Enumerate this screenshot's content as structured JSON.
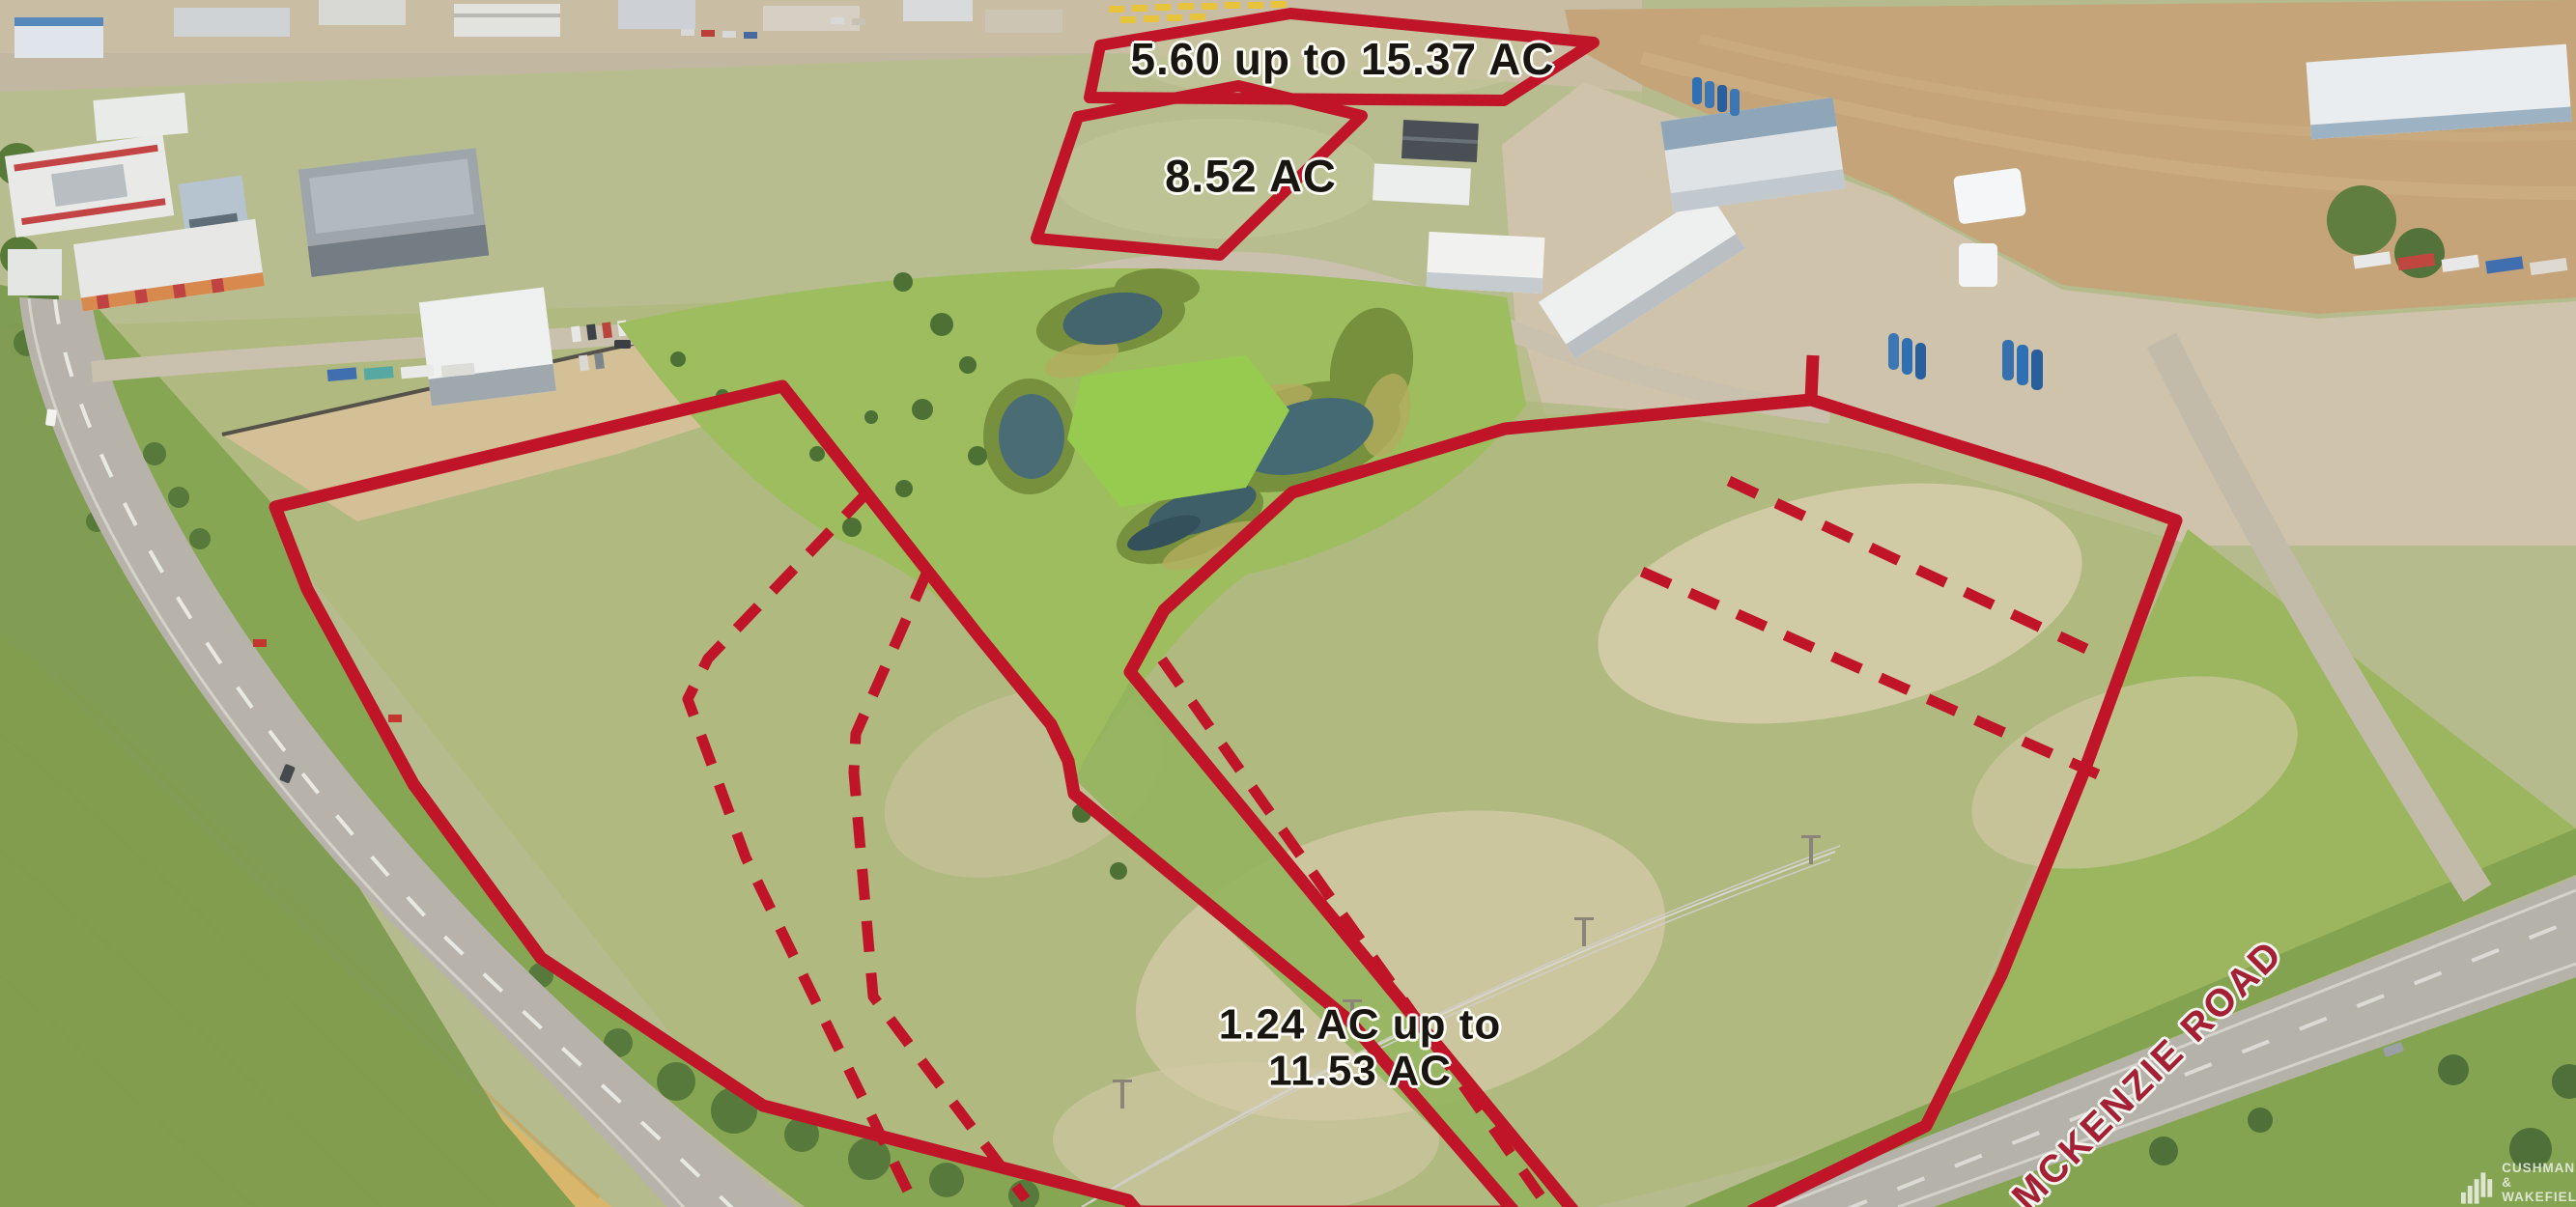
{
  "parcels": {
    "top": {
      "label": "5.60 up to 15.37 AC",
      "outline_style": "solid"
    },
    "middle": {
      "label": "8.52 AC",
      "outline_style": "solid"
    },
    "main": {
      "label_line1": "1.24 AC up to",
      "label_line2": "11.53 AC",
      "outline_style": "solid-with-dashed-subdivisions"
    }
  },
  "road": {
    "label": "MCKENZIE ROAD"
  },
  "logo": {
    "line1": "CUSHMAN &",
    "line2": "WAKEFIELD"
  },
  "colors": {
    "parcel_outline": "#c01428",
    "road_label": "#a32035",
    "parcel_label_text": "#191511",
    "label_halo": "#fdfdf6"
  }
}
